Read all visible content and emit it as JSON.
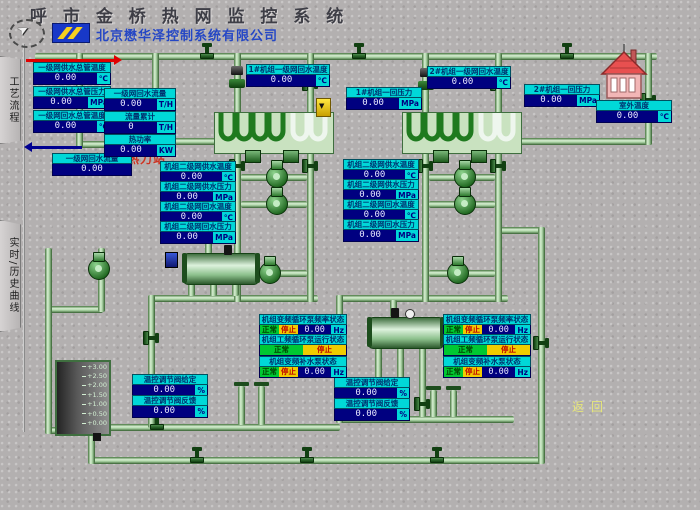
{
  "header": {
    "title": "呼 市 金 桥 热 网 监 控 系 统",
    "company": "北京懋华泽控制系统有限公司"
  },
  "sidebar": {
    "tab_process": "工艺流程",
    "tab_curves": "实时/历史曲线"
  },
  "station_name": "后巧报热力站",
  "return_label": "返回",
  "gauges": {
    "sup_temp": {
      "label": "一级网供水总管温度",
      "value": "0.00",
      "unit": "℃"
    },
    "sup_pres": {
      "label": "一级网供水总管压力",
      "value": "0.00",
      "unit": "MPa"
    },
    "ret_temp": {
      "label": "一级网回水总管温度",
      "value": "0.00",
      "unit": "℃"
    },
    "ret_flow": {
      "label": "一级网回水流量",
      "value": "0.00",
      "unit": ""
    },
    "u1_ret_temp": {
      "label": "1#机组一级网回水温度",
      "value": "0.00",
      "unit": "℃"
    },
    "u1_pres": {
      "label": "1#机组一回压力",
      "value": "0.00",
      "unit": "MPa"
    },
    "u2_ret_temp": {
      "label": "2#机组一级网回水温度",
      "value": "0.00",
      "unit": "℃"
    },
    "u2_pres": {
      "label": "2#机组一回压力",
      "value": "0.00",
      "unit": "MPa"
    },
    "outdoor_temp": {
      "label": "室外温度",
      "value": "0.00",
      "unit": "℃"
    },
    "u1_sec_sup_temp": {
      "label": "机组二级网供水温度",
      "value": "0.00",
      "unit": "℃"
    },
    "u1_sec_sup_pres": {
      "label": "机组二级网供水压力",
      "value": "0.00",
      "unit": "MPa"
    },
    "u1_sec_ret_temp": {
      "label": "机组二级网回水温度",
      "value": "0.00",
      "unit": "℃"
    },
    "u1_sec_ret_pres": {
      "label": "机组二级网回水压力",
      "value": "0.00",
      "unit": "MPa"
    },
    "u2_sec_sup_temp": {
      "label": "机组二级网供水温度",
      "value": "0.00",
      "unit": "℃"
    },
    "u2_sec_sup_pres": {
      "label": "机组二级网供水压力",
      "value": "0.00",
      "unit": "MPa"
    },
    "u2_sec_ret_temp": {
      "label": "机组二级网回水温度",
      "value": "0.00",
      "unit": "℃"
    },
    "u2_sec_ret_pres": {
      "label": "机组二级网回水压力",
      "value": "0.00",
      "unit": "MPa"
    },
    "u1_valve_sp": {
      "label": "温控调节阀给定",
      "value": "0.00",
      "unit": "%"
    },
    "u1_valve_fb": {
      "label": "温控调节阀反馈",
      "value": "0.00",
      "unit": "%"
    },
    "u2_valve_sp": {
      "label": "温控调节阀给定",
      "value": "0.00",
      "unit": "%"
    },
    "u2_valve_fb": {
      "label": "温控调节阀反馈",
      "value": "0.00",
      "unit": "%"
    }
  },
  "flow_meter": {
    "rows": [
      {
        "label": "一级网回水流量",
        "value": "0.00",
        "unit": "T/H"
      },
      {
        "label": "流量累计",
        "value": "0",
        "unit": "T/H"
      },
      {
        "label": "热功率",
        "value": "0.00",
        "unit": "KW"
      }
    ]
  },
  "status": {
    "u1_vfd_circ": {
      "label": "机组变频循环泵频率状态",
      "normal": "正常",
      "stop": "停止",
      "value": "0.00",
      "unit": "Hz"
    },
    "u1_pf_circ": {
      "label": "机组工频循环泵运行状态",
      "normal": "正常",
      "stop": "停止"
    },
    "u1_vfd_makeup": {
      "label": "机组变频补水泵状态",
      "normal": "正常",
      "stop": "停止",
      "value": "0.00",
      "unit": "Hz"
    },
    "u2_vfd_circ": {
      "label": "机组变频循环泵频率状态",
      "normal": "正常",
      "stop": "停止",
      "value": "0.00",
      "unit": "Hz"
    },
    "u2_pf_circ": {
      "label": "机组工频循环泵运行状态",
      "normal": "正常",
      "stop": "停止"
    },
    "u2_vfd_makeup": {
      "label": "机组变频补水泵状态",
      "normal": "正常",
      "stop": "停止",
      "value": "0.00",
      "unit": "Hz"
    }
  },
  "tank": {
    "scale": [
      "+3.00",
      "+2.50",
      "+2.00",
      "+1.50",
      "+1.00",
      "+0.50",
      "+0.00"
    ]
  }
}
